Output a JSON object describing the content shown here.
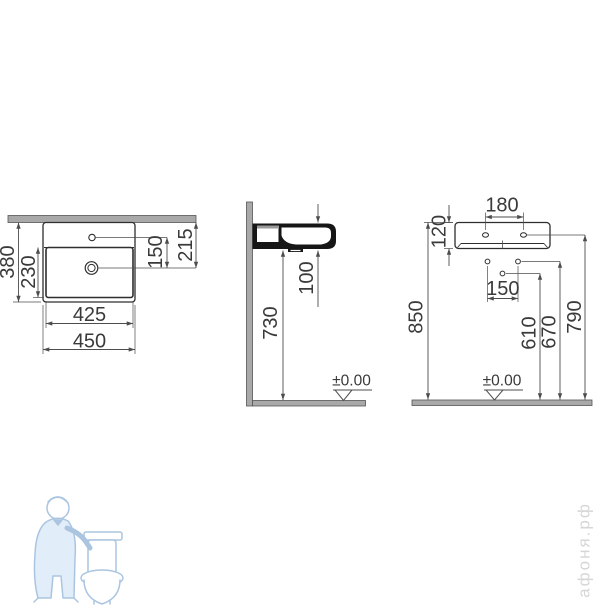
{
  "drawing": {
    "title_hint": "wall-hung washbasin installation dimensions",
    "top_view": {
      "overall_depth": "380",
      "bowl_depth": "230",
      "hole_to_drain": "150",
      "wall_to_drain": "215",
      "inner_width": "425",
      "overall_width": "450"
    },
    "side_view": {
      "drain_offset": "100",
      "floor_to_underside": "730",
      "floor_level": "±0.00"
    },
    "front_view": {
      "tap_hole_spacing": "180",
      "body_height": "120",
      "fixing_hole_spacing": "150",
      "floor_to_lower_hole": "610",
      "floor_to_fixing_holes": "670",
      "floor_to_mount_holes": "790",
      "floor_to_top": "850",
      "floor_level": "±0.00"
    }
  },
  "watermark": {
    "site": "афоня.рф"
  },
  "colors": {
    "dimension_line": "#4d4d4d",
    "object_line": "#2e2e2e",
    "label_text": "#3a3a3a",
    "wall_fill": "#a9a9a9",
    "section_fill": "#161616",
    "watermark_blue": "#9dbcdc",
    "watermark_fill": "#dcebf7",
    "watermark_text": "#d6d6d6"
  }
}
